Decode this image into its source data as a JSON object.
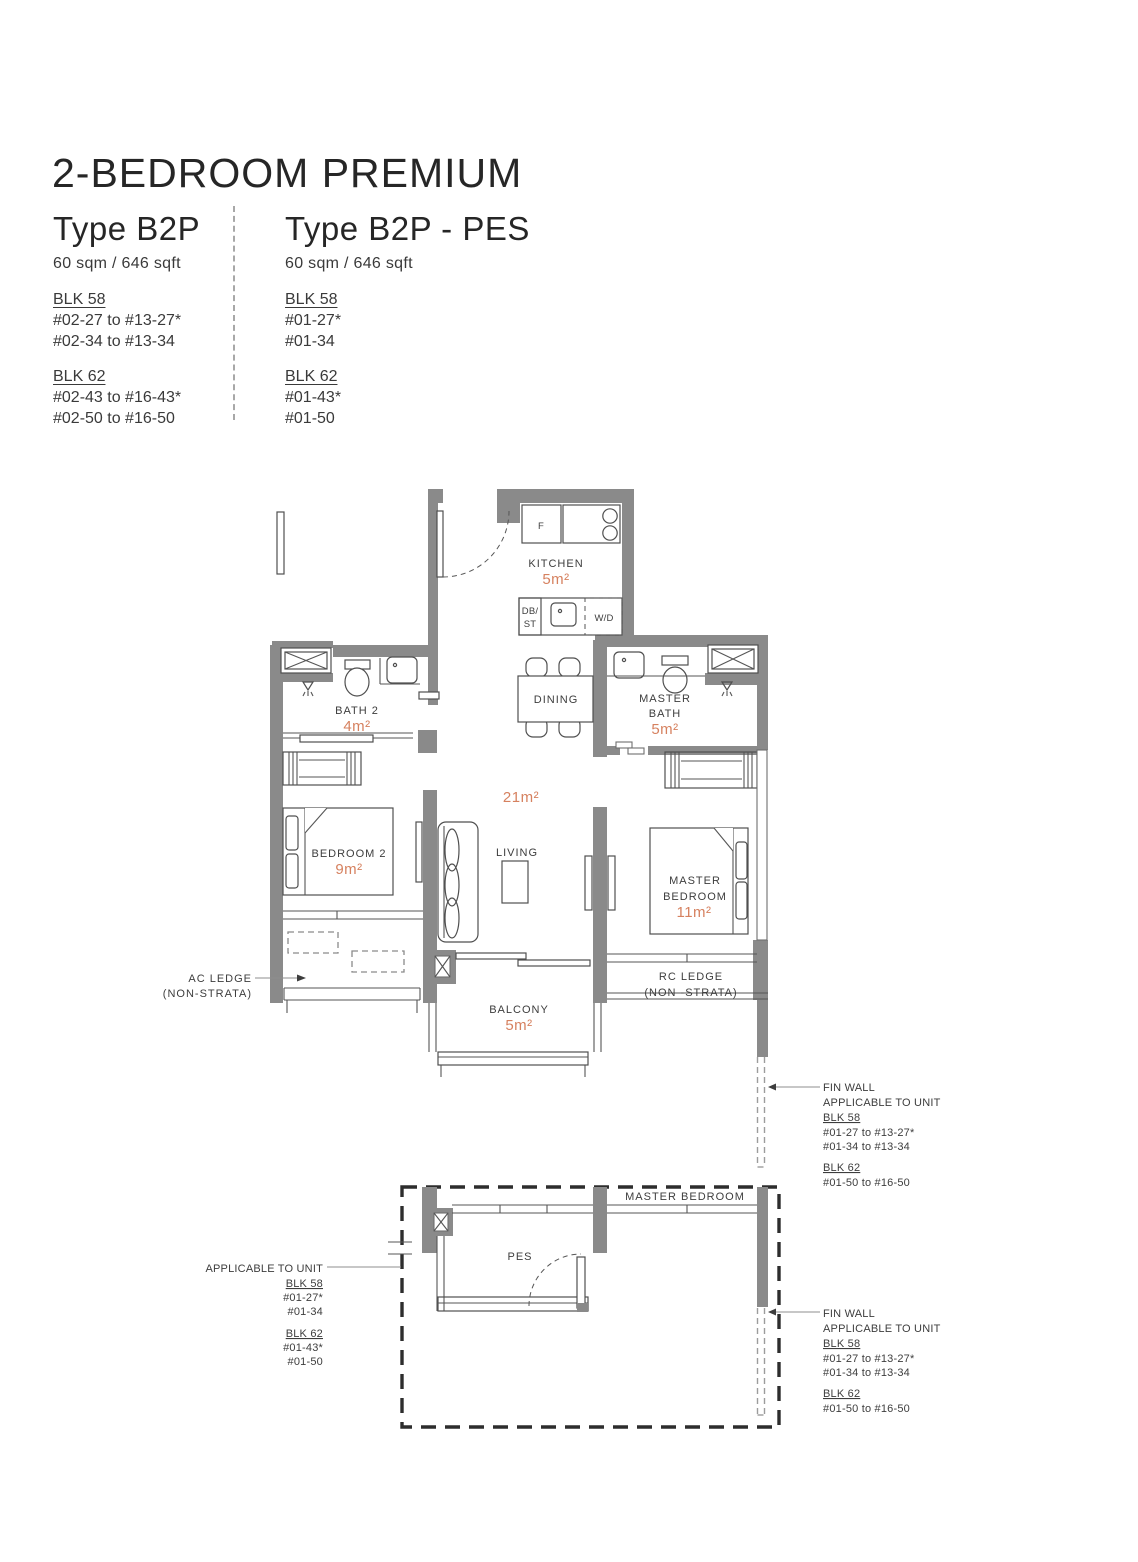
{
  "colors": {
    "accent": "#d6815f",
    "wall": "#8a8a8a",
    "line": "#4f4f4f",
    "text": "#3d3d3d"
  },
  "header": {
    "title": "2-BEDROOM PREMIUM",
    "types": [
      {
        "name": "Type B2P",
        "area": "60 sqm / 646 sqft",
        "blocks": [
          {
            "label": "BLK 58",
            "units": [
              "#02-27 to #13-27*",
              "#02-34 to #13-34"
            ]
          },
          {
            "label": "BLK 62",
            "units": [
              "#02-43 to #16-43*",
              "#02-50 to #16-50"
            ]
          }
        ]
      },
      {
        "name": "Type B2P - PES",
        "area": "60 sqm / 646 sqft",
        "blocks": [
          {
            "label": "BLK 58",
            "units": [
              "#01-27*",
              "#01-34"
            ]
          },
          {
            "label": "BLK 62",
            "units": [
              "#01-43*",
              "#01-50"
            ]
          }
        ]
      }
    ]
  },
  "plan": {
    "kitchen": {
      "label": "KITCHEN",
      "area": "5m²"
    },
    "bath2": {
      "label": "BATH 2",
      "area": "4m²"
    },
    "dining": {
      "label": "DINING"
    },
    "master_bath": {
      "line1": "MASTER",
      "line2": "BATH",
      "area": "5m²"
    },
    "living": {
      "label": "LIVING",
      "area": "21m²"
    },
    "bedroom2": {
      "label": "BEDROOM 2",
      "area": "9m²"
    },
    "master_bedroom": {
      "line1": "MASTER",
      "line2": "BEDROOM",
      "area": "11m²"
    },
    "balcony": {
      "label": "BALCONY",
      "area": "5m²"
    },
    "ac_ledge": {
      "line1": "AC LEDGE",
      "line2": "(NON-STRATA)"
    },
    "rc_ledge": {
      "line1": "RC LEDGE",
      "line2": "(NON -STRATA)"
    },
    "fixtures": {
      "fridge": "F",
      "db_line1": "DB/",
      "db_line2": "ST",
      "washer": "W/D"
    }
  },
  "pes_plan": {
    "master_bedroom": "MASTER BEDROOM",
    "pes": "PES"
  },
  "annotations": {
    "fin_wall_upper": {
      "title": "FIN WALL",
      "subtitle": "APPLICABLE TO UNIT",
      "blocks": [
        {
          "label": "BLK 58",
          "units": [
            "#01-27 to #13-27*",
            "#01-34 to #13-34"
          ]
        },
        {
          "label": "BLK 62",
          "units": [
            "#01-50 to #16-50"
          ]
        }
      ]
    },
    "fin_wall_lower": {
      "title": "FIN WALL",
      "subtitle": "APPLICABLE TO UNIT",
      "blocks": [
        {
          "label": "BLK 58",
          "units": [
            "#01-27 to #13-27*",
            "#01-34 to #13-34"
          ]
        },
        {
          "label": "BLK 62",
          "units": [
            "#01-50 to #16-50"
          ]
        }
      ]
    },
    "pes_applicable": {
      "title": "APPLICABLE TO UNIT",
      "blocks": [
        {
          "label": "BLK 58",
          "units": [
            "#01-27*",
            "#01-34"
          ]
        },
        {
          "label": "BLK 62",
          "units": [
            "#01-43*",
            "#01-50"
          ]
        }
      ]
    }
  }
}
